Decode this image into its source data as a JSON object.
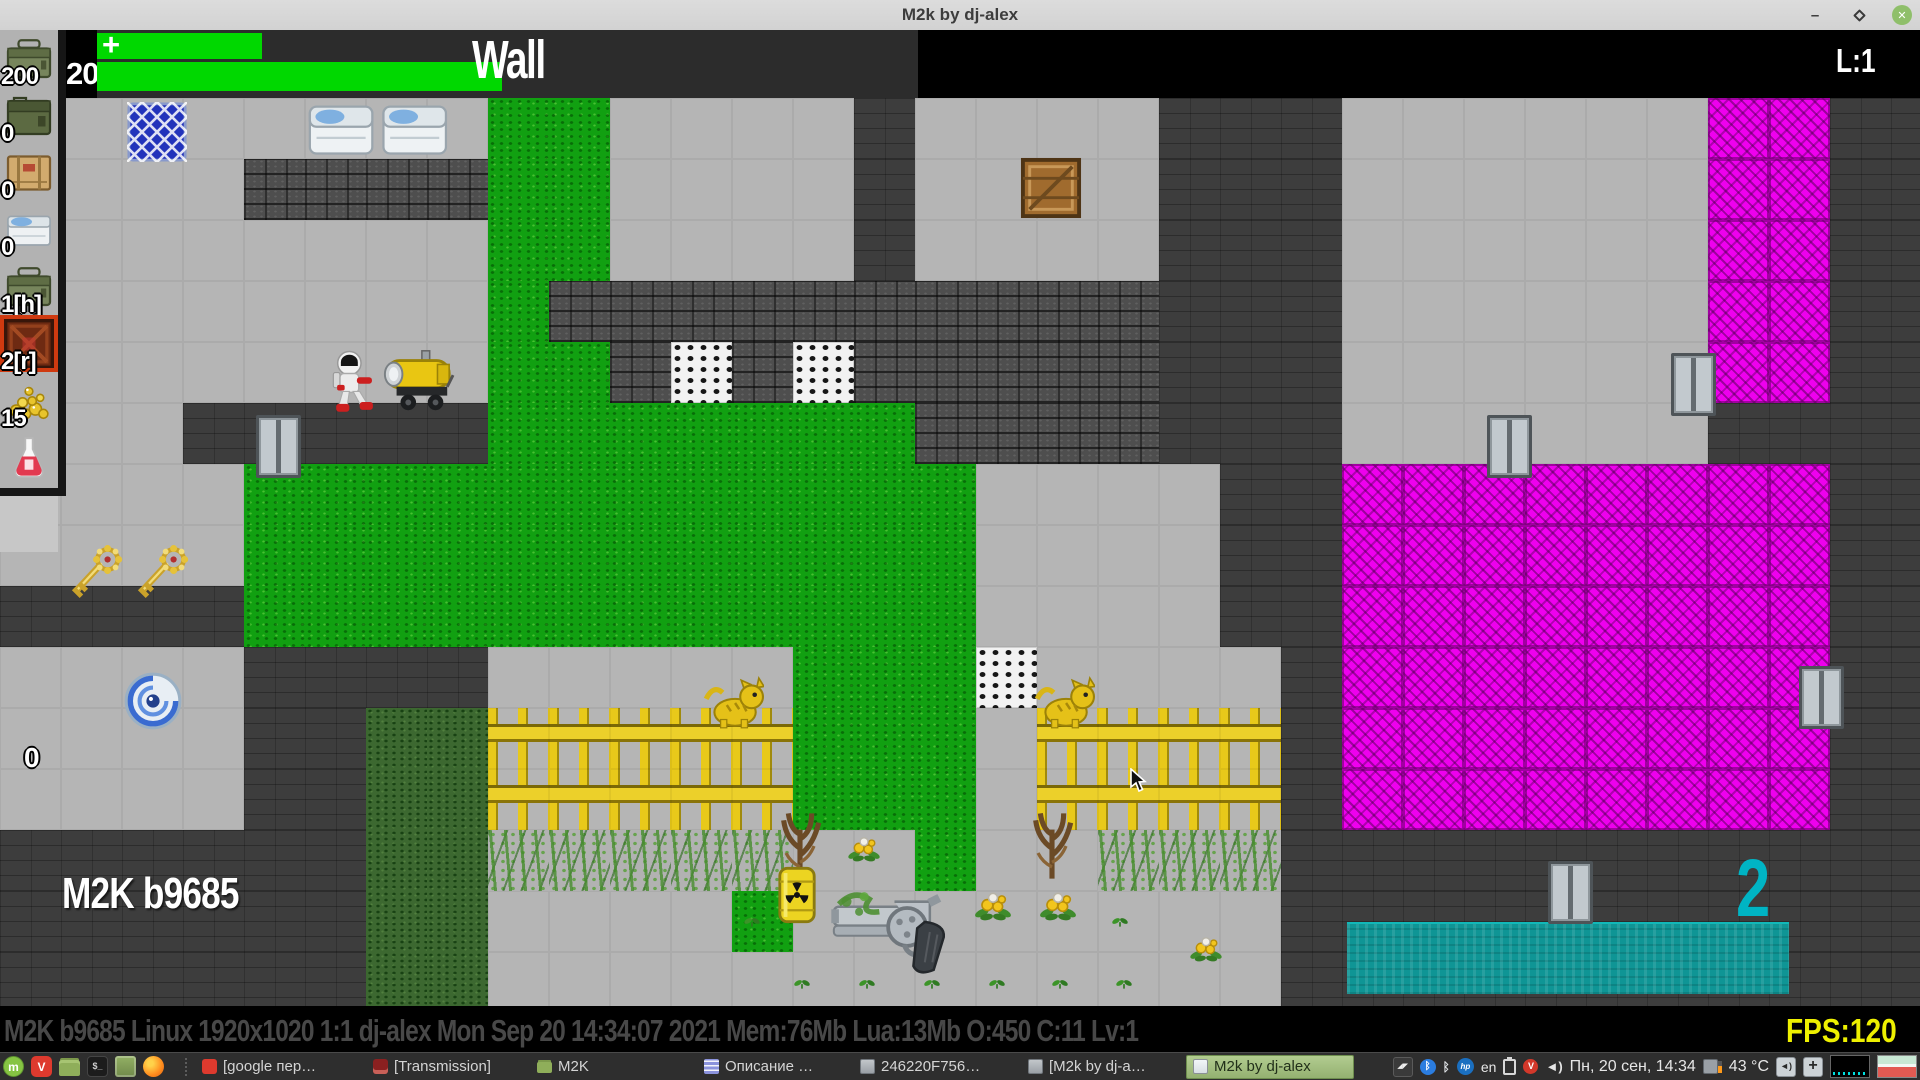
{
  "window": {
    "title": "M2k by dj-alex",
    "controls": {
      "minimize": "–",
      "close": "✕"
    }
  },
  "hud": {
    "counter": "200",
    "plus": "+",
    "title": "Wall",
    "level": "L:1"
  },
  "labels": {
    "zero": "0",
    "watermark": "M2K b9685",
    "score": "2"
  },
  "status": {
    "text": "M2K b9685 Linux 1920x1020 1:1 dj-alex Mon Sep 20 14:34:07 2021 Mem:76Mb Lua:13Mb O:450 C:11 Lv:1",
    "fps": "FPS:120"
  },
  "sidebar": {
    "slots": [
      {
        "icon": "ammo-can-green",
        "label": "200",
        "selected": false
      },
      {
        "icon": "ammo-box-dark",
        "label": "0",
        "selected": false
      },
      {
        "icon": "crate-tan",
        "label": "0",
        "selected": false
      },
      {
        "icon": "med-box",
        "label": "0",
        "selected": false
      },
      {
        "icon": "ammo-can-green",
        "label": "1[h]",
        "selected": false
      },
      {
        "icon": "red-crate",
        "label": "2[r]",
        "selected": true
      },
      {
        "icon": "gold-pile",
        "label": "15",
        "selected": false
      },
      {
        "icon": "flask",
        "label": "",
        "selected": false
      }
    ]
  },
  "map": {
    "tile": 61,
    "codes": {
      ".": "wall",
      "F": "floor",
      "G": "grass",
      "g": "moss",
      "M": "magenta-wall",
      "S": "stone-brick",
      "C": "checker",
      "T": "water",
      "Y": "fence",
      "V": "vines"
    },
    "rows": [
      "FFFFFFFFGGFFFF.FFFF...FFFFFFMM..",
      "FFFFSSSSGGFFFF.FFFF...FFFFFFMM..",
      "FFFFFFFFGGFFFF.FFFF...FFFFFFMM..",
      "FFFFFFFFGSSSSSSSSSS...FFFFFFMM..",
      "FFFFFFFFGGSCSCSSSSS...FFFFFFMM..",
      "FFF.....GGGGGGGSSSS...FFFFFF....",
      "FFFFGGGGGGGGGGGGFFFF..MMMMMMMM..",
      "FFFFGGGGGGGGGGGGFFFF..MMMMMMMM..",
      "....GGGGGGGGGGGGFFFF..MMMMMMMM..",
      "FFFF....FFFFFGGGCFFFF.MMMMMMMM..",
      "FFFF..ggYYYYYGGGFYYYY.MMMMMMMM..",
      "FFFF..ggYYYYYGGGFYYYY.MMMMMMMM..",
      "......ggVVVVVFFGFFVVV...........",
      "......ggFFFFGFFFFFFFF...........",
      "......ggFFFFFFFFFFFFF..........."
    ]
  },
  "sprites": [
    {
      "n": "teleport-pad",
      "x": 127,
      "y": 102,
      "w": 60,
      "h": 60,
      "i": true
    },
    {
      "n": "supply-boxes",
      "x": 304,
      "y": 100,
      "w": 150,
      "h": 58,
      "i": true
    },
    {
      "n": "wooden-crate",
      "x": 1020,
      "y": 157,
      "w": 62,
      "h": 62,
      "i": true
    },
    {
      "n": "player-astronaut",
      "x": 332,
      "y": 350,
      "w": 46,
      "h": 64,
      "i": true
    },
    {
      "n": "heater",
      "x": 381,
      "y": 348,
      "w": 74,
      "h": 66,
      "i": true
    },
    {
      "n": "elevator-door",
      "x": 256,
      "y": 415,
      "w": 45,
      "h": 63,
      "i": true
    },
    {
      "n": "elevator-door",
      "x": 1487,
      "y": 415,
      "w": 45,
      "h": 63,
      "i": true
    },
    {
      "n": "elevator-door",
      "x": 1671,
      "y": 353,
      "w": 45,
      "h": 63,
      "i": true
    },
    {
      "n": "elevator-door",
      "x": 1799,
      "y": 666,
      "w": 45,
      "h": 63,
      "i": true
    },
    {
      "n": "elevator-door",
      "x": 1548,
      "y": 861,
      "w": 45,
      "h": 63,
      "i": true
    },
    {
      "n": "gold-key",
      "x": 64,
      "y": 540,
      "w": 62,
      "h": 68,
      "i": true
    },
    {
      "n": "gold-key",
      "x": 130,
      "y": 540,
      "w": 62,
      "h": 68,
      "i": true
    },
    {
      "n": "portal",
      "x": 120,
      "y": 668,
      "w": 66,
      "h": 66,
      "i": true
    },
    {
      "n": "cat",
      "x": 702,
      "y": 674,
      "w": 62,
      "h": 58,
      "i": true
    },
    {
      "n": "cat",
      "x": 1033,
      "y": 674,
      "w": 62,
      "h": 58,
      "i": true
    },
    {
      "n": "twigs",
      "x": 772,
      "y": 796,
      "w": 56,
      "h": 86,
      "i": false
    },
    {
      "n": "twigs",
      "x": 1024,
      "y": 796,
      "w": 56,
      "h": 86,
      "i": false
    },
    {
      "n": "barrel",
      "x": 776,
      "y": 863,
      "w": 42,
      "h": 64,
      "i": true
    },
    {
      "n": "revolver",
      "x": 828,
      "y": 884,
      "w": 138,
      "h": 96,
      "i": true
    },
    {
      "n": "flower",
      "x": 846,
      "y": 834,
      "w": 36,
      "h": 28,
      "i": false
    },
    {
      "n": "flower",
      "x": 973,
      "y": 889,
      "w": 40,
      "h": 32,
      "i": false
    },
    {
      "n": "flower",
      "x": 1038,
      "y": 889,
      "w": 40,
      "h": 32,
      "i": false
    },
    {
      "n": "flower",
      "x": 1188,
      "y": 934,
      "w": 36,
      "h": 28,
      "i": false
    },
    {
      "n": "sprout",
      "x": 743,
      "y": 914,
      "w": 18,
      "h": 14,
      "i": false
    },
    {
      "n": "sprout",
      "x": 1111,
      "y": 914,
      "w": 18,
      "h": 14,
      "i": false
    },
    {
      "n": "sprout",
      "x": 793,
      "y": 976,
      "w": 18,
      "h": 14,
      "i": false
    },
    {
      "n": "sprout",
      "x": 858,
      "y": 976,
      "w": 18,
      "h": 14,
      "i": false
    },
    {
      "n": "sprout",
      "x": 923,
      "y": 976,
      "w": 18,
      "h": 14,
      "i": false
    },
    {
      "n": "sprout",
      "x": 988,
      "y": 976,
      "w": 18,
      "h": 14,
      "i": false
    },
    {
      "n": "sprout",
      "x": 1051,
      "y": 976,
      "w": 18,
      "h": 14,
      "i": false
    },
    {
      "n": "sprout",
      "x": 1115,
      "y": 976,
      "w": 18,
      "h": 14,
      "i": false
    },
    {
      "n": "water-pool",
      "x": 1347,
      "y": 922,
      "w": 442,
      "h": 72,
      "i": false
    }
  ],
  "taskbar": {
    "launchers": [
      {
        "n": "mint-menu",
        "g": "m"
      },
      {
        "n": "vivaldi-launch",
        "g": "V"
      },
      {
        "n": "files",
        "g": ""
      },
      {
        "n": "terminal",
        "g": "$_"
      },
      {
        "n": "green-app",
        "g": ""
      },
      {
        "n": "firefox",
        "g": ""
      }
    ],
    "windows": [
      {
        "icon": "vivaldi",
        "label": "[google пер…",
        "w": 165,
        "active": false
      },
      {
        "icon": "transmission",
        "label": "[Transmission]",
        "w": 158,
        "active": false
      },
      {
        "icon": "folder",
        "label": "M2K",
        "w": 85,
        "active": false
      },
      {
        "spacer": 70
      },
      {
        "icon": "doc",
        "label": "Описание …",
        "w": 150,
        "active": false
      },
      {
        "icon": "win-gray",
        "label": "246220F756…",
        "w": 162,
        "active": false
      },
      {
        "icon": "win-gray",
        "label": "[M2k by dj-a…",
        "w": 158,
        "active": false
      },
      {
        "icon": "win-light",
        "label": "M2k by dj-alex",
        "w": 168,
        "active": true
      }
    ],
    "tray": [
      {
        "n": "flash-icon",
        "g": "◢◤"
      },
      {
        "n": "bluetooth-blue",
        "g": "ᛒ"
      },
      {
        "n": "bluetooth-plain",
        "g": "ᛒ"
      },
      {
        "n": "hp-badge",
        "g": "hp"
      },
      {
        "n": "keyboard-layout",
        "t": "en"
      },
      {
        "n": "clipboard"
      },
      {
        "n": "red-badge",
        "g": "V"
      },
      {
        "n": "volume",
        "g": "◄)"
      },
      {
        "n": "clock",
        "t": "Пн, 20 сен, 14:34"
      },
      {
        "n": "cpu-monitor"
      },
      {
        "n": "temperature",
        "t": "43 °C"
      },
      {
        "n": "audio-box",
        "g": "◄)"
      },
      {
        "n": "move-box",
        "g": "+"
      },
      {
        "n": "graph-black"
      },
      {
        "n": "graph-stripes"
      }
    ]
  }
}
